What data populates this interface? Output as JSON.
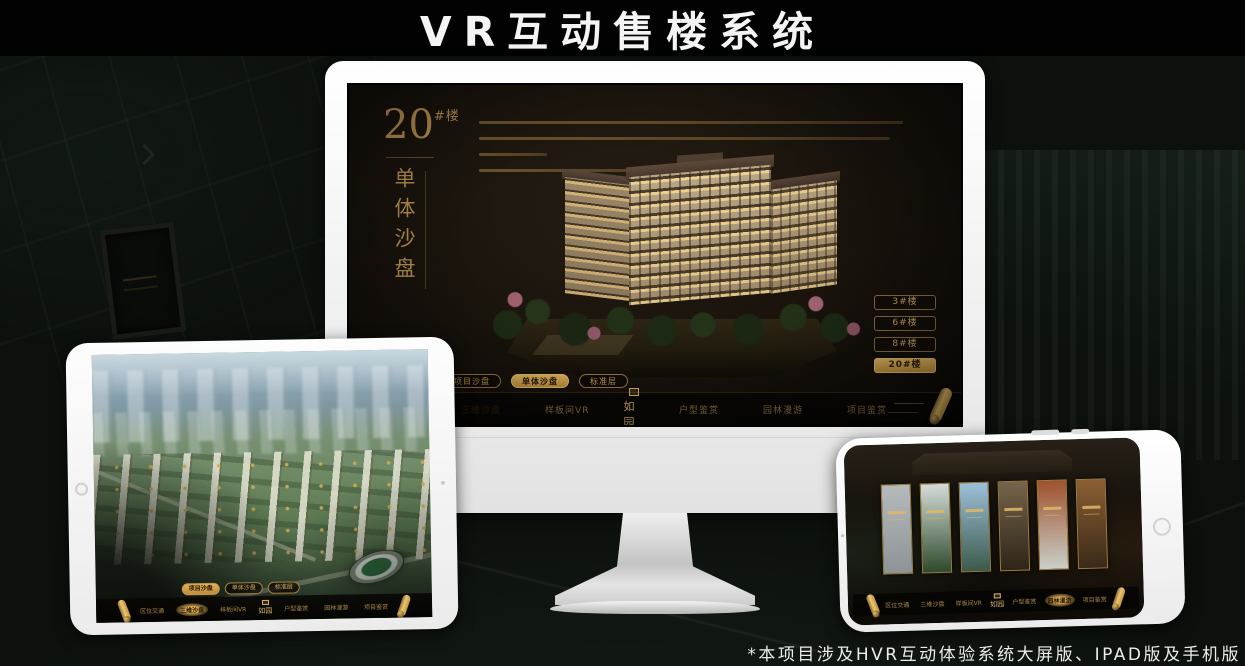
{
  "page": {
    "title": "VR互动售楼系统",
    "footnote": "*本项目涉及HVR互动体验系统大屏版、IPAD版及手机版"
  },
  "brand": {
    "logo_text": "如园",
    "accent_gold": "#d4a94e",
    "accent_gold_dark": "#8a6f3f",
    "screen_bg": "#17110b"
  },
  "monitor": {
    "heading": {
      "number": "20",
      "suffix": "#楼",
      "subtitle": "单体沙盘"
    },
    "tower_buttons": [
      {
        "label": "3#楼",
        "active": false
      },
      {
        "label": "6#楼",
        "active": false
      },
      {
        "label": "8#楼",
        "active": false
      },
      {
        "label": "20#楼",
        "active": true
      }
    ],
    "sub_tabs": [
      {
        "label": "项目沙盘",
        "active": false
      },
      {
        "label": "单体沙盘",
        "active": true
      },
      {
        "label": "标准层",
        "active": false
      }
    ],
    "nav": {
      "items_left": [
        {
          "label": "区位交通",
          "active": false
        },
        {
          "label": "三维沙盘",
          "active": true
        },
        {
          "label": "样板间VR",
          "active": false
        }
      ],
      "items_right": [
        {
          "label": "户型鉴赏",
          "active": false
        },
        {
          "label": "园林漫游",
          "active": false
        },
        {
          "label": "项目鉴赏",
          "active": false
        }
      ]
    }
  },
  "tablet": {
    "sub_tabs": [
      {
        "label": "项目沙盘",
        "active": true
      },
      {
        "label": "单体沙盘",
        "active": false
      },
      {
        "label": "标准层",
        "active": false
      }
    ],
    "nav": {
      "items_left": [
        {
          "label": "区位交通",
          "active": false
        },
        {
          "label": "三维沙盘",
          "active": true
        },
        {
          "label": "样板间VR",
          "active": false
        }
      ],
      "items_right": [
        {
          "label": "户型鉴赏",
          "active": false
        },
        {
          "label": "园林漫游",
          "active": false
        },
        {
          "label": "项目鉴赏",
          "active": false
        }
      ]
    }
  },
  "phone": {
    "nav": {
      "items_left": [
        {
          "label": "区位交通",
          "active": false
        },
        {
          "label": "三维沙盘",
          "active": false
        },
        {
          "label": "样板间VR",
          "active": false
        }
      ],
      "items_right": [
        {
          "label": "户型鉴赏",
          "active": false
        },
        {
          "label": "园林漫游",
          "active": true
        },
        {
          "label": "项目鉴赏",
          "active": false
        }
      ]
    },
    "panels": [
      {
        "name": "sketch-gallery",
        "top": "#b5babd",
        "bottom": "#8e9396"
      },
      {
        "name": "courtyard-view",
        "top": "#d5dcd8",
        "bottom": "#2f4a2c"
      },
      {
        "name": "sky-tower-view",
        "top": "#9cc0da",
        "bottom": "#3c5a4a"
      },
      {
        "name": "facade-night",
        "top": "#76644a",
        "bottom": "#2e2519"
      },
      {
        "name": "autumn-scene",
        "top": "#a0522d",
        "bottom": "#c9cfc9"
      },
      {
        "name": "interior-warm",
        "top": "#8a5f33",
        "bottom": "#3a2a18"
      }
    ]
  }
}
